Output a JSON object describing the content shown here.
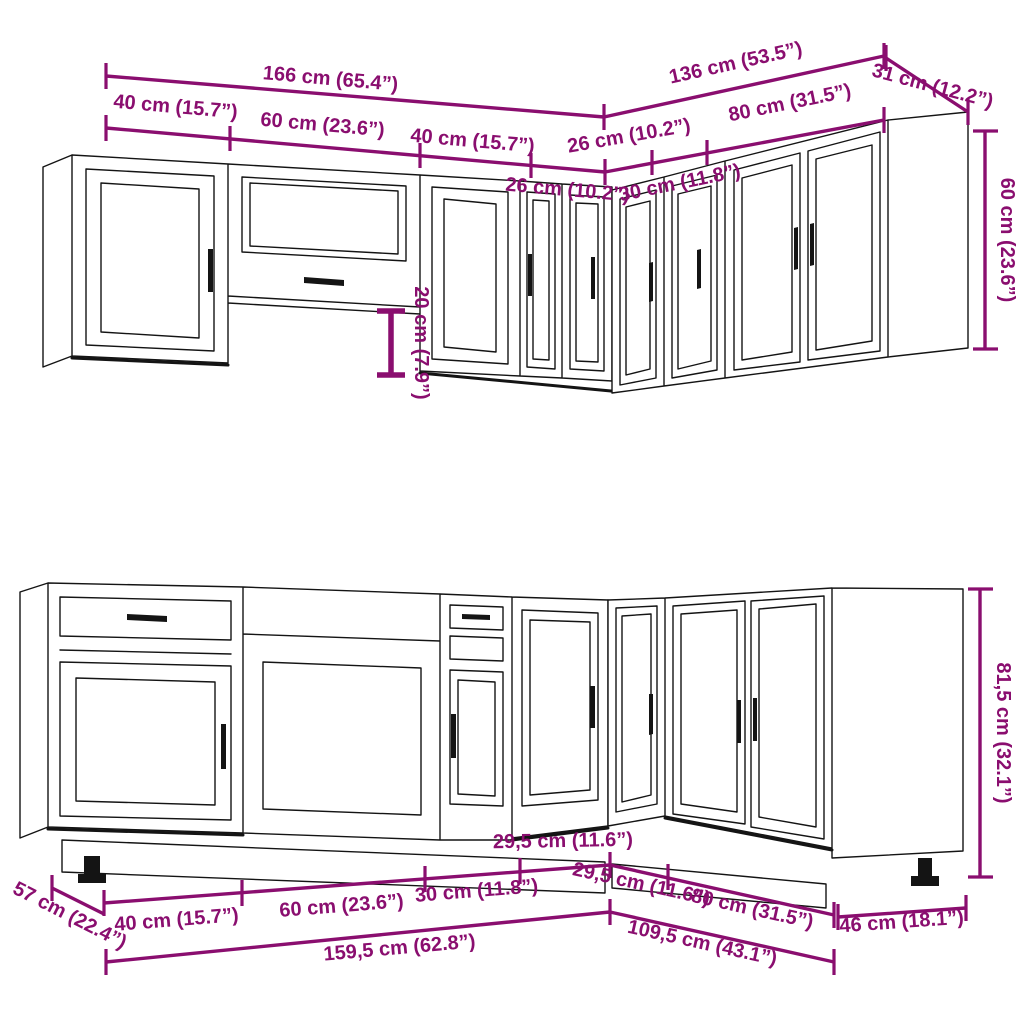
{
  "colors": {
    "dimension": "#8A0E6F",
    "line": "#141414",
    "background": "#FFFFFF"
  },
  "upper_section": {
    "total_width_left": "166 cm (65.4”)",
    "total_width_right": "136 cm (53.5”)",
    "end_depth": "31 cm (12.2”)",
    "cabinet_widths_left": {
      "w40_1": "40 cm (15.7”)",
      "w60": "60 cm (23.6”)",
      "w40_2": "40 cm (15.7”)",
      "w26_front": "26 cm (10.2”)"
    },
    "cabinet_widths_right": {
      "w26_corner": "26 cm (10.2”)",
      "w30": "30 cm (11.8”)",
      "w80": "80 cm (31.5”)"
    },
    "cabinet_height": "60 cm (23.6”)",
    "gap_below_bridge": "20 cm (7.9”)"
  },
  "lower_section": {
    "depth_left": "57 cm (22.4”)",
    "cabinet_widths_left": {
      "w40": "40 cm (15.7”)",
      "w60": "60 cm (23.6”)",
      "w30": "30 cm (11.8”)",
      "w295": "29,5 cm (11.6”)"
    },
    "cabinet_widths_right": {
      "w295": "29,5 cm (11.6”)",
      "w80": "80 cm (31.5”)"
    },
    "total_width_left": "159,5 cm (62.8”)",
    "total_width_right": "109,5 cm (43.1”)",
    "end_depth": "46 cm (18.1”)",
    "cabinet_height": "81,5 cm (32.1”)"
  }
}
